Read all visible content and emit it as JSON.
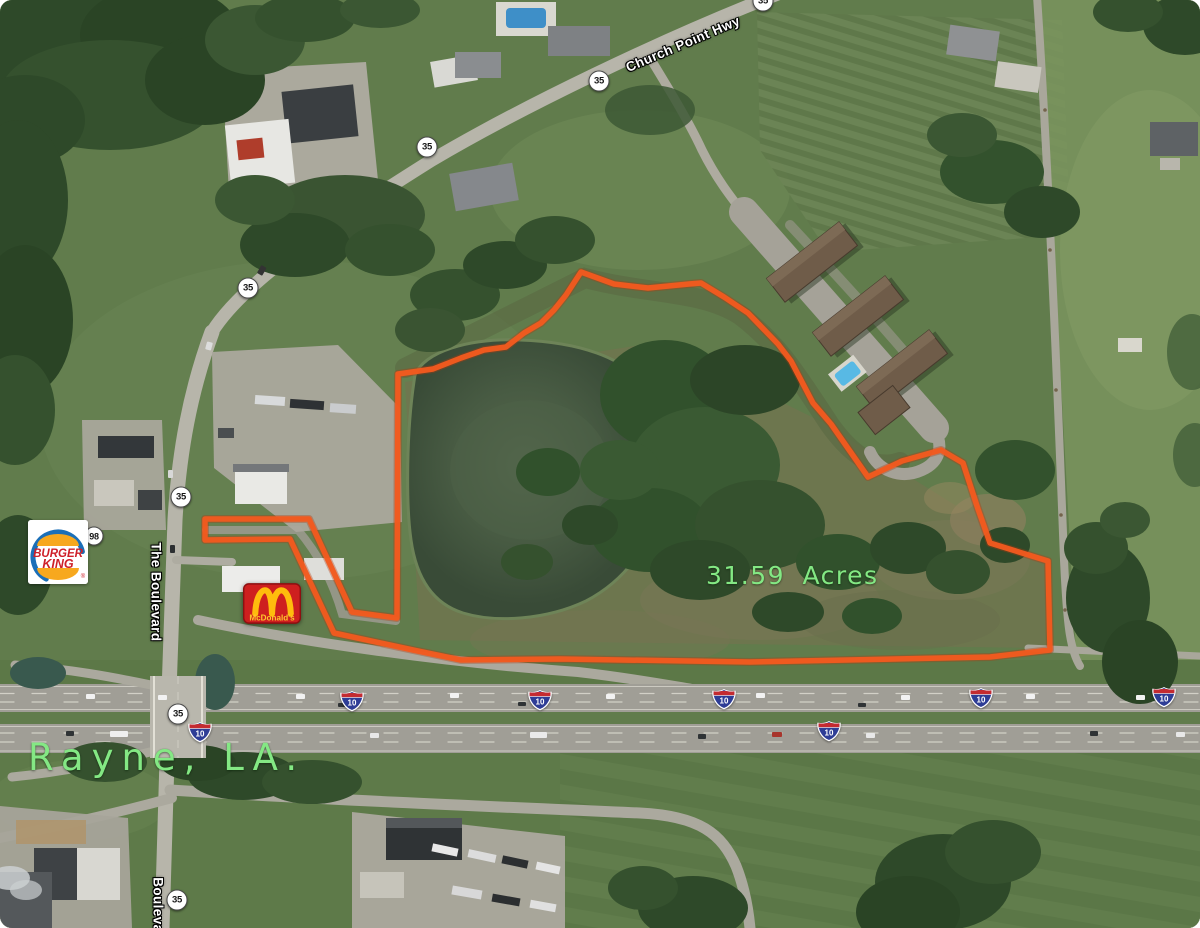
{
  "map": {
    "city_label": "Rayne, LA.",
    "acreage_label": "31.59  Acres",
    "road_labels": {
      "church_point_hwy": "Church Point Hwy",
      "the_boulevard": "The Boulevard",
      "boulevard_south": "Boulevard"
    },
    "route_shields": {
      "la_35": "35",
      "la_98": "98",
      "interstate_10": "10"
    },
    "logos": {
      "burger_king_line1": "BURGER",
      "burger_king_line2": "KING",
      "burger_king_reg": "®",
      "mcdonalds": "McDonald's"
    },
    "colors": {
      "boundary_orange": "#F25A1E",
      "label_green": "#84E884",
      "road_label_white": "#FFFFFF",
      "interstate_blue": "#2E3D96",
      "interstate_red": "#C42B31"
    }
  }
}
